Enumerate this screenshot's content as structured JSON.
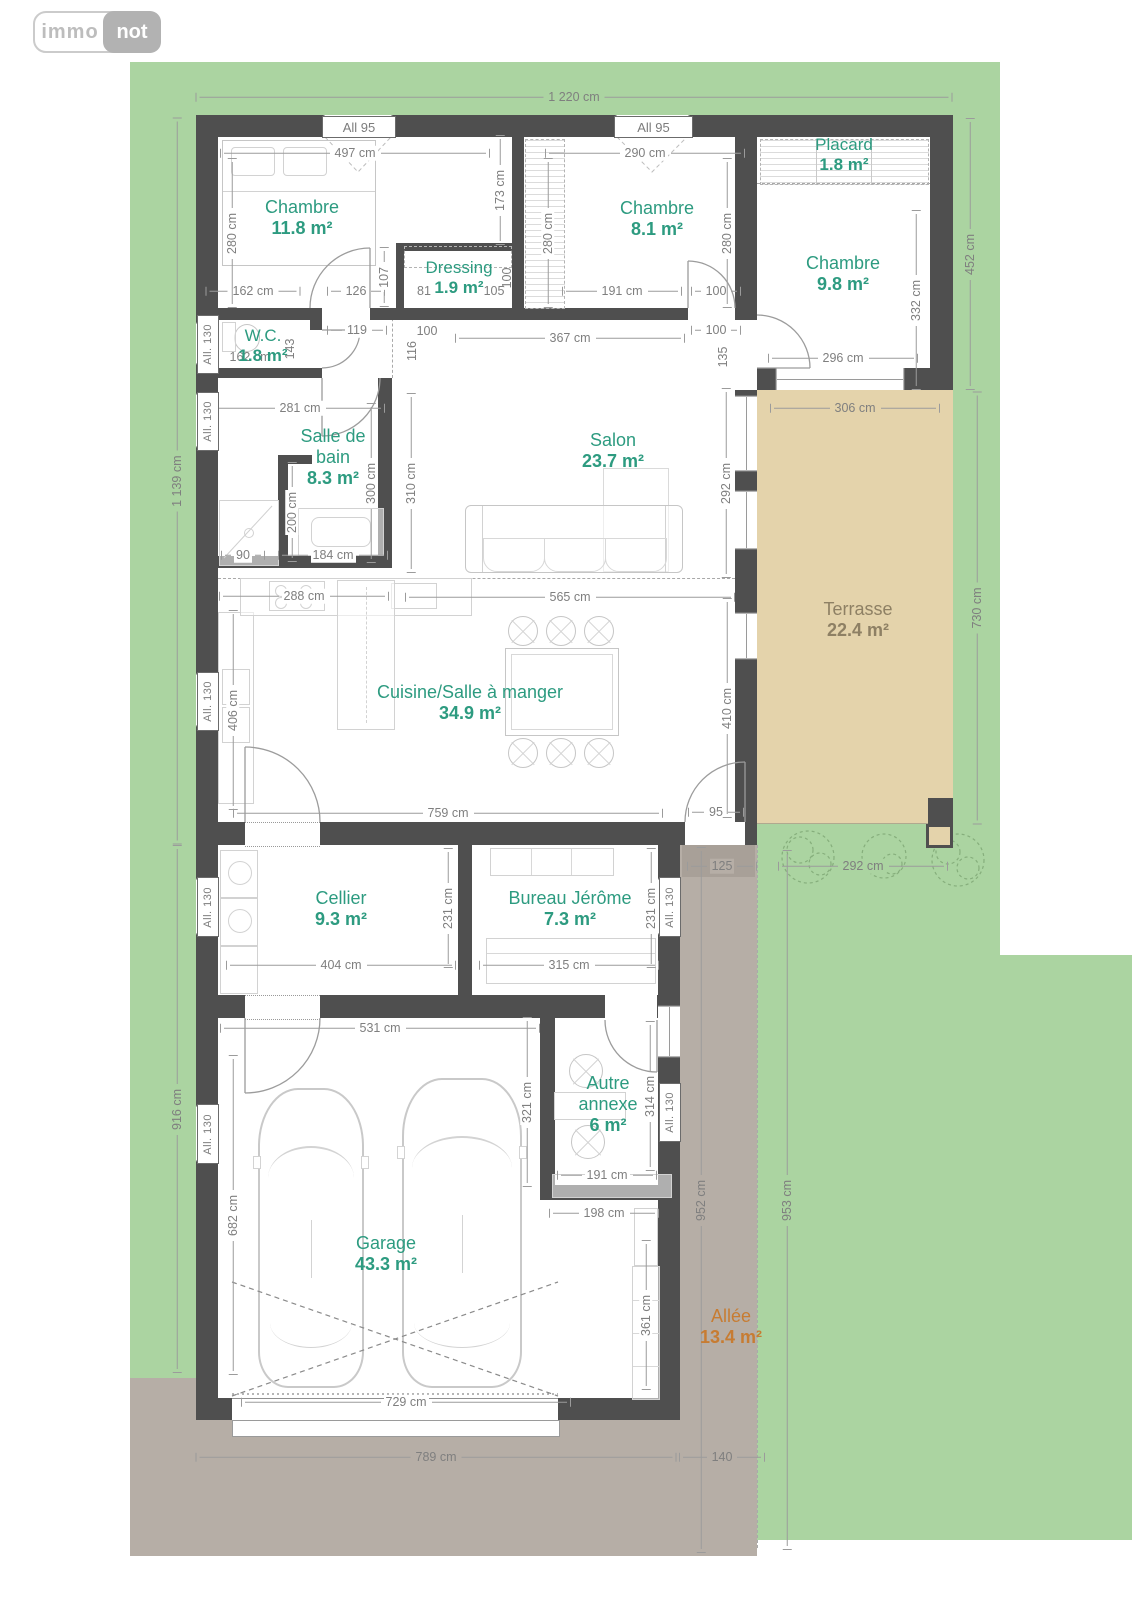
{
  "logo": {
    "immo": "immo",
    "not": "not"
  },
  "windows": {
    "all95": "All 95",
    "all130": "All. 130"
  },
  "rooms": {
    "chambre1": {
      "name": "Chambre",
      "area": "11.8 m²"
    },
    "dressing": {
      "name": "Dressing",
      "area": "1.9 m²"
    },
    "chambre2": {
      "name": "Chambre",
      "area": "8.1 m²"
    },
    "placard": {
      "name": "Placard",
      "area": "1.8 m²"
    },
    "chambre3": {
      "name": "Chambre",
      "area": "9.8 m²"
    },
    "wc": {
      "name": "W.C.",
      "area": "1.8 m²"
    },
    "salle_de_bain": {
      "name": "Salle de bain",
      "area": "8.3 m²"
    },
    "salon": {
      "name": "Salon",
      "area": "23.7 m²"
    },
    "cuisine": {
      "name": "Cuisine/Salle à manger",
      "area": "34.9 m²"
    },
    "terrasse": {
      "name": "Terrasse",
      "area": "22.4 m²"
    },
    "cellier": {
      "name": "Cellier",
      "area": "9.3 m²"
    },
    "bureau": {
      "name": "Bureau Jérôme",
      "area": "7.3 m²"
    },
    "garage": {
      "name": "Garage",
      "area": "43.3 m²"
    },
    "annexe": {
      "name": "Autre annexe",
      "area": "6 m²"
    },
    "allee": {
      "name": "Allée",
      "area": "13.4 m²"
    }
  },
  "dims": {
    "d1220": "1 220 cm",
    "d1139": "1 139 cm",
    "d916": "916 cm",
    "d452": "452 cm",
    "d730": "730 cm",
    "d952": "952 cm",
    "d953": "953 cm",
    "d789": "789 cm",
    "d140": "140",
    "d497": "497 cm",
    "d290": "290 cm",
    "d306": "306 cm",
    "d296": "296 cm",
    "d565": "565 cm",
    "d759": "759 cm",
    "d95": "95",
    "d531": "531 cm",
    "d729": "729 cm",
    "d404": "404 cm",
    "d315": "315 cm",
    "d191": "191 cm",
    "d198": "198 cm",
    "d292": "292 cm",
    "d125": "125",
    "d162": "162 cm",
    "d126": "126",
    "d100": "100",
    "d119": "119",
    "d367": "367 cm",
    "d281": "281 cm",
    "d90": "90",
    "d184": "184 cm",
    "d288": "288 cm",
    "d81": "81",
    "d105": "105",
    "d280": "280 cm",
    "d107": "107",
    "d173": "173 cm",
    "d332": "332 cm",
    "d116": "116",
    "d135": "135",
    "d143": "143",
    "d300": "300 cm",
    "d310": "310 cm",
    "d200": "200 cm",
    "d406": "406 cm",
    "d410": "410 cm",
    "d231": "231 cm",
    "d682": "682 cm",
    "d321": "321 cm",
    "d314": "314 cm",
    "d361": "361 cm"
  },
  "colors": {
    "lawn": "#abd4a1",
    "driveway": "#b6aea6",
    "terrace_floor": "#e4d3ab",
    "wall": "#4f4f4f",
    "room_label": "#2d9b80",
    "dim_text": "#7f7f7f",
    "terrace_label": "#8e8064",
    "driveway_label": "#c77c32",
    "logo_gray": "#b2b2b2"
  }
}
